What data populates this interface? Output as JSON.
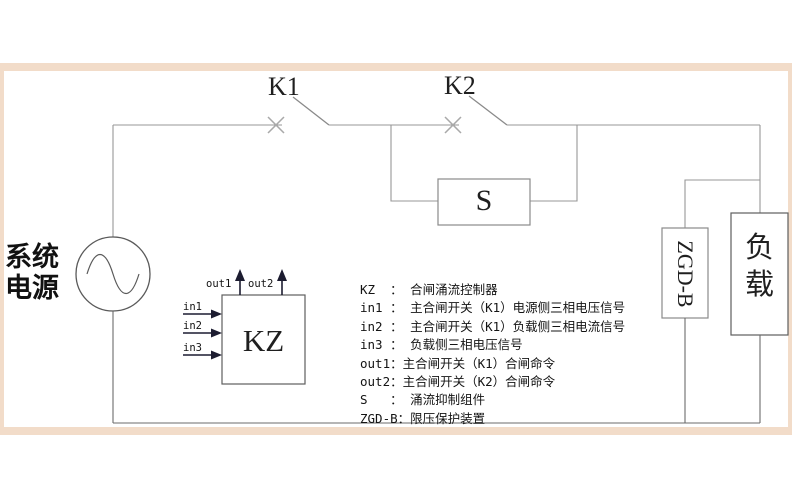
{
  "colors": {
    "frame": "#f2dcc9",
    "canvas": "#ffffff",
    "wire_light": "#979797",
    "wire_dark": "#6b6b6b",
    "arrow": "#1c1c30"
  },
  "source": {
    "label_line1": "系统",
    "label_line2": "电源"
  },
  "switches": {
    "k1_label": "K1",
    "k2_label": "K2"
  },
  "boxes": {
    "suppressor_label": "S",
    "controller_label": "KZ",
    "voltage_limiter_label": "ZGD-B",
    "load_char1": "负",
    "load_char2": "载"
  },
  "ports": {
    "in1": "in1",
    "in2": "in2",
    "in3": "in3",
    "out1": "out1",
    "out2": "out2"
  },
  "legend": {
    "lines": [
      "KZ  ： 合闸涌流控制器",
      "in1 ： 主合闸开关（K1）电源侧三相电压信号",
      "in2 ： 主合闸开关（K1）负载侧三相电流信号",
      "in3 ： 负载侧三相电压信号",
      "out1：主合闸开关（K1）合闸命令",
      "out2：主合闸开关（K2）合闸命令",
      "S   ： 涌流抑制组件",
      "ZGD-B：限压保护装置"
    ]
  }
}
